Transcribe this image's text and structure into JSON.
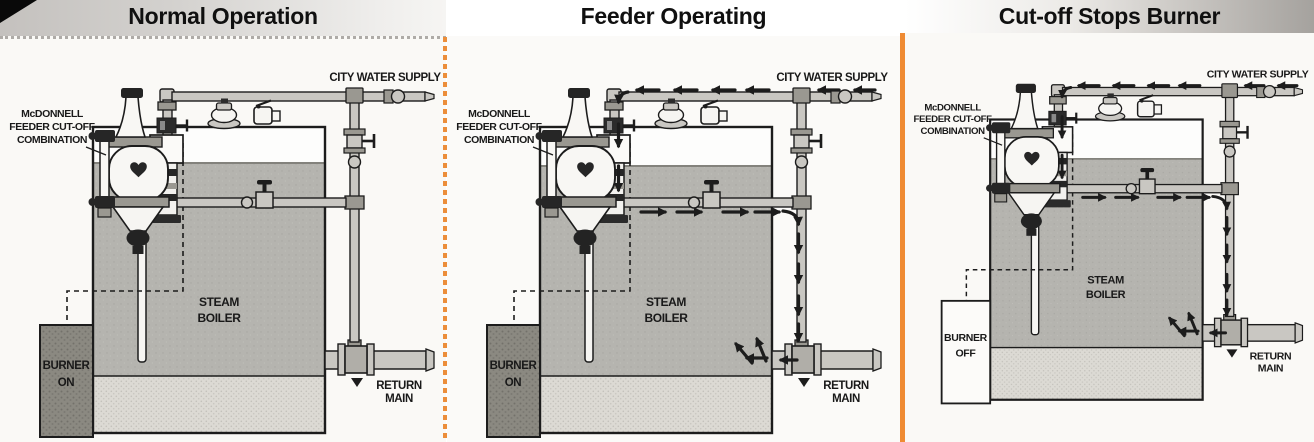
{
  "figure": {
    "description_visible_text_only": true,
    "accent_divider_dashed_color": "#ec8e3a",
    "accent_divider_solid_color": "#ef8b33",
    "ink_color": "#1c1c1c",
    "pipe_color": "#c9c7c2",
    "water_color": "#b5b4af",
    "stipple_color": "#dcdad4",
    "burner_dark_color": "#8b8981",
    "corner_fold_color": "#090909"
  },
  "labels": {
    "city_water_supply": "CITY WATER SUPPLY",
    "feeder_line1": "McDONNELL",
    "feeder_line2": "FEEDER CUT-OFF",
    "feeder_line3": "COMBINATION",
    "boiler_line1": "STEAM",
    "boiler_line2": "BOILER",
    "return_line1": "RETURN",
    "return_line2": "MAIN",
    "burner_word": "BURNER"
  },
  "panels": [
    {
      "id": "normal-operation",
      "title": "Normal Operation",
      "burner_state": "ON",
      "burner_style": "dark",
      "flow_arrows": false,
      "water_top": 163
    },
    {
      "id": "feeder-operating",
      "title": "Feeder Operating",
      "burner_state": "ON",
      "burner_style": "dark",
      "flow_arrows": true,
      "water_top": 166
    },
    {
      "id": "cutoff-stops-burner",
      "title": "Cut-off Stops Burner",
      "burner_state": "OFF",
      "burner_style": "light",
      "flow_arrows": true,
      "water_top": 170
    }
  ]
}
